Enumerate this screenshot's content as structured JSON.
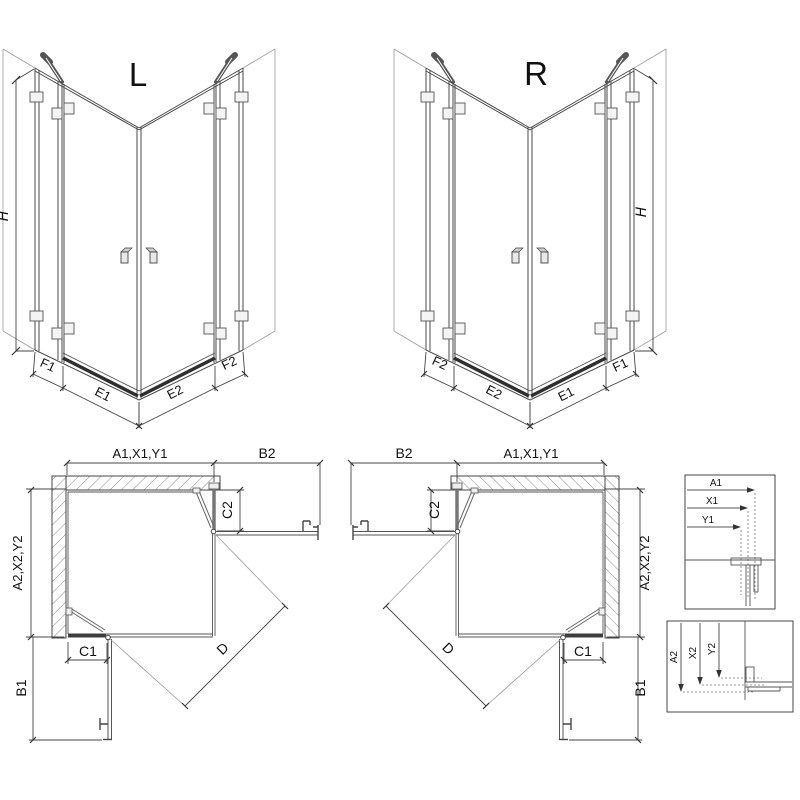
{
  "drawing": {
    "iso_left": {
      "title": "L",
      "height_dim": "H",
      "bottom_dims": [
        "F1",
        "E1",
        "E2",
        "F2"
      ]
    },
    "iso_right": {
      "title": "R",
      "height_dim": "H",
      "bottom_dims": [
        "F2",
        "E2",
        "E1",
        "F1"
      ]
    },
    "plan_left": {
      "width_dim": "A1,X1,Y1",
      "swing_side_dim": "B2",
      "depth_dim": "A2,X2,Y2",
      "upper_offset_dim": "C2",
      "lower_offset_dim": "C1",
      "swing_bottom_dim": "B1",
      "diagonal_dim": "D"
    },
    "plan_right": {
      "width_dim": "A1,X1,Y1",
      "swing_side_dim": "B2",
      "depth_dim": "A2,X2,Y2",
      "upper_offset_dim": "C2",
      "lower_offset_dim": "C1",
      "swing_bottom_dim": "B1",
      "diagonal_dim": "D"
    },
    "detail_width": {
      "dims": [
        "A1",
        "X1",
        "Y1"
      ]
    },
    "detail_depth": {
      "dims": [
        "A2",
        "X2",
        "Y2"
      ]
    }
  },
  "colors": {
    "line": "#4a4a4a",
    "dim": "#444444",
    "hatch": "#7a7a7a",
    "threshold": "#2f2f2f",
    "background": "#ffffff"
  }
}
